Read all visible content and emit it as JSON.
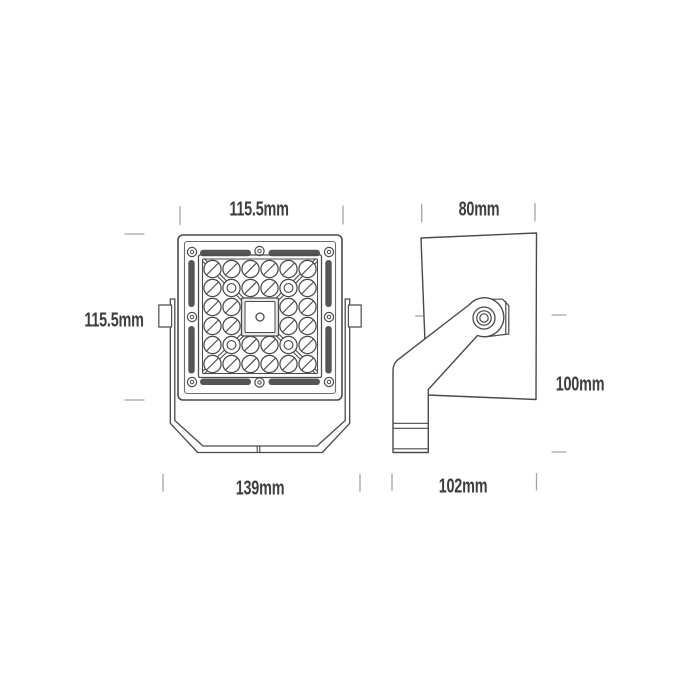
{
  "colors": {
    "background": "#ffffff",
    "outline": "#4a4a4a",
    "secondary_line": "#6e6e6e",
    "dimension_tick": "#a3a3a8",
    "label_text": "#3e3e3e",
    "gasket_slot": "#555555",
    "plate_shade": "#e9e9e9"
  },
  "front_view": {
    "dimensions": {
      "top_width": "115.5mm",
      "left_height": "115.5mm",
      "bottom_width": "139mm"
    },
    "led_grid": {
      "rows": 6,
      "cols": 6,
      "visible_lens_count": 32,
      "cross_lens_count": 4
    },
    "screw_count": 8
  },
  "side_view": {
    "dimensions": {
      "top_depth": "80mm",
      "right_height": "100mm",
      "bottom_depth": "102mm"
    }
  }
}
